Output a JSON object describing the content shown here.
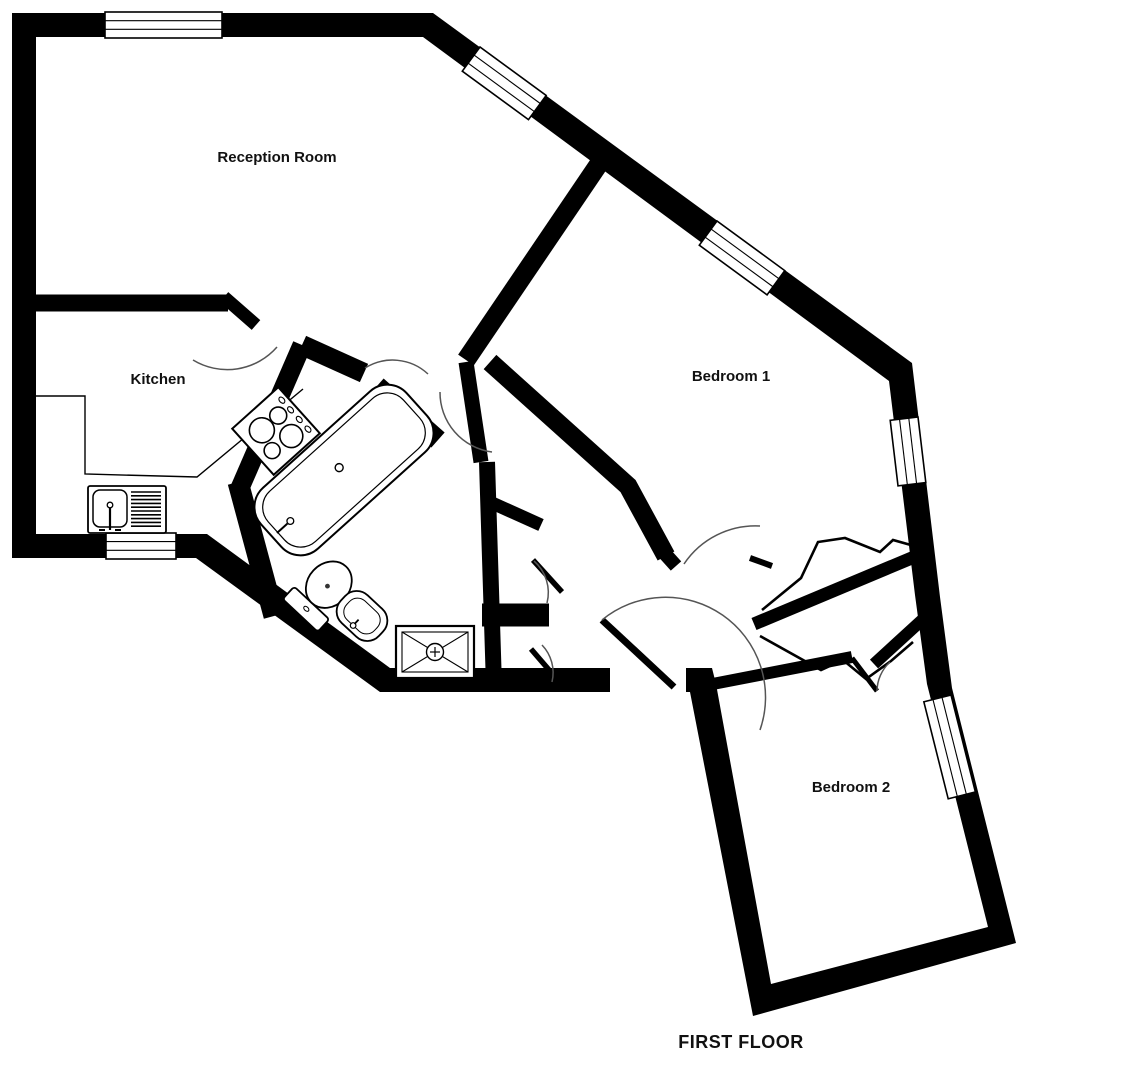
{
  "floor_plan": {
    "title": "FIRST FLOOR",
    "rooms": [
      {
        "name": "Reception Room"
      },
      {
        "name": "Kitchen"
      },
      {
        "name": "Bedroom 1"
      },
      {
        "name": "Bedroom 2"
      }
    ],
    "colors": {
      "walls": "#000000",
      "background": "#ffffff",
      "text": "#111111"
    },
    "fixtures": [
      "bathtub",
      "toilet",
      "wash-basin",
      "shower-tray",
      "kitchen-sink-drainer",
      "cooker-hob",
      "kitchen-counter",
      "wardrobe-folding-doors"
    ],
    "window_count": 6,
    "floor_label_position": "bottom-right"
  }
}
